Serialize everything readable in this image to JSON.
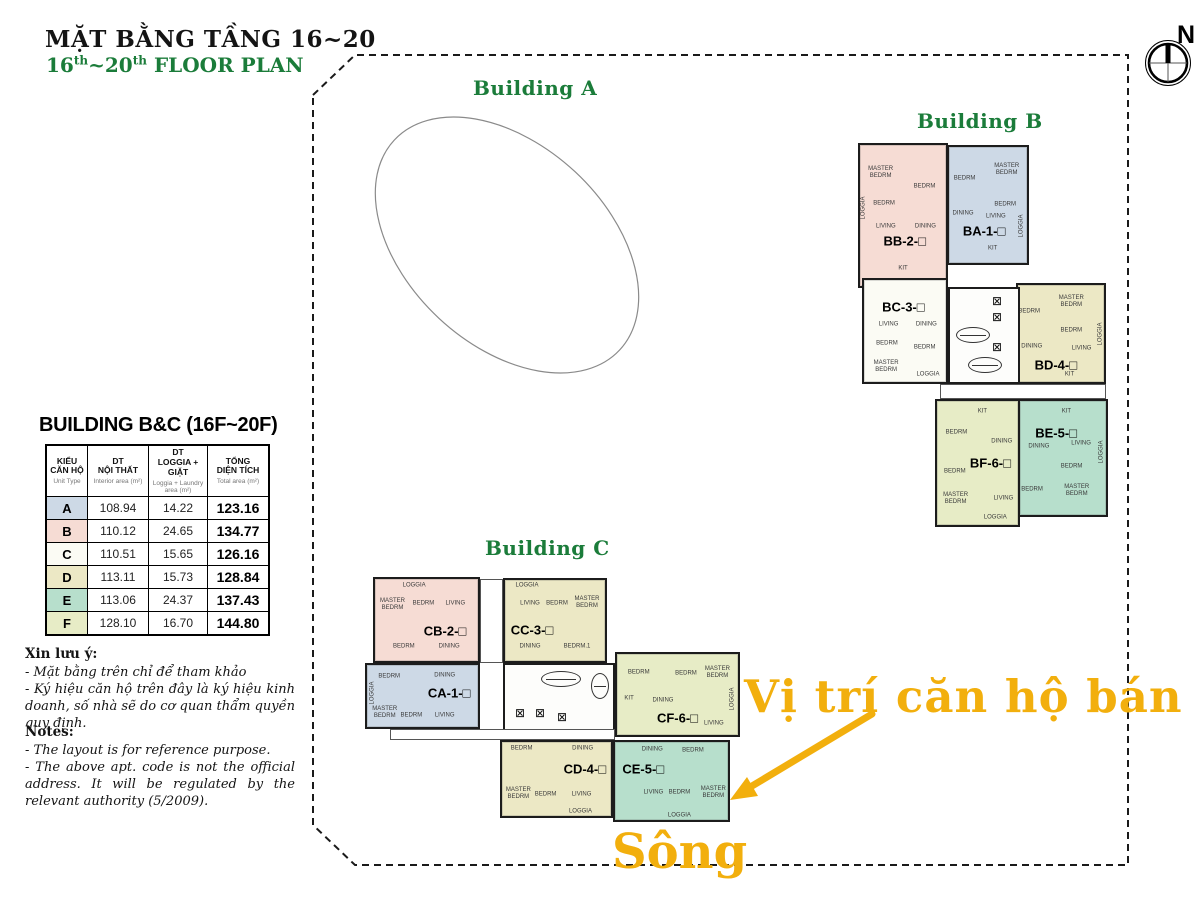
{
  "header": {
    "title_vi": "MẶT BẰNG TẦNG 16~20",
    "title_en": {
      "p1": "16",
      "s1": "th",
      "p2": "~20",
      "s2": "th",
      "p3": " FLOOR PLAN"
    }
  },
  "compass": {
    "label": "N"
  },
  "buildings": {
    "a": "Building A",
    "b": "Building B",
    "c": "Building C"
  },
  "table": {
    "title": "BUILDING B&C (16F~20F)",
    "headers": [
      {
        "vi": "KIỂU\nCĂN HỘ",
        "en": "Unit Type"
      },
      {
        "vi": "DT\nNỘI THẤT",
        "en": "Interior area (m²)"
      },
      {
        "vi": "DT\nLOGGIA + GIẶT",
        "en": "Loggia + Laundry\narea (m²)"
      },
      {
        "vi": "TỔNG\nDIỆN TÍCH",
        "en": "Total area (m²)"
      }
    ],
    "rows": [
      {
        "type": "A",
        "interior": "108.94",
        "loggia": "14.22",
        "total": "123.16",
        "color": "blue"
      },
      {
        "type": "B",
        "interior": "110.12",
        "loggia": "24.65",
        "total": "134.77",
        "color": "pink"
      },
      {
        "type": "C",
        "interior": "110.51",
        "loggia": "15.65",
        "total": "126.16",
        "color": "white"
      },
      {
        "type": "D",
        "interior": "113.11",
        "loggia": "15.73",
        "total": "128.84",
        "color": "cream"
      },
      {
        "type": "E",
        "interior": "113.06",
        "loggia": "24.37",
        "total": "137.43",
        "color": "teal"
      },
      {
        "type": "F",
        "interior": "128.10",
        "loggia": "16.70",
        "total": "144.80",
        "color": "green"
      }
    ]
  },
  "notes_vi": {
    "title": "Xin lưu ý:",
    "lines": [
      "- Mặt bằng trên chỉ để tham khảo",
      "- Ký hiệu căn hộ trên đây là ký hiệu kinh doanh, số nhà sẽ do cơ quan thẩm quyền quy định."
    ]
  },
  "notes_en": {
    "title": "Notes:",
    "lines": [
      "- The layout is for reference purpose.",
      "- The above apt. code is not the official address. It will be regulated by the relevant authority (5/2009)."
    ]
  },
  "annotations": {
    "sale_location": "Vị trí căn hộ bán",
    "river": "Sông",
    "accent_color": "#F2AF0D"
  },
  "icons": {
    "elevator": "⊠"
  },
  "plan": {
    "colors": {
      "pink": "#f6dcd4",
      "blue": "#cdd9e6",
      "cream": "#ece8c5",
      "teal": "#b7dfcc",
      "green": "#e7ecc6",
      "white": "#fbfbf4"
    },
    "units": [
      {
        "code": "BB-2-□",
        "color": "pink",
        "x": 858,
        "y": 143,
        "w": 90,
        "h": 145,
        "lx": 0.52,
        "ly": 0.68,
        "rooms": [
          {
            "n": "MASTER\nBEDRM",
            "x": 0.24,
            "y": 0.2
          },
          {
            "n": "BEDRM",
            "x": 0.75,
            "y": 0.3
          },
          {
            "n": "BEDRM",
            "x": 0.28,
            "y": 0.42
          },
          {
            "n": "LIVING",
            "x": 0.3,
            "y": 0.58
          },
          {
            "n": "DINING",
            "x": 0.76,
            "y": 0.58
          },
          {
            "n": "KIT",
            "x": 0.5,
            "y": 0.88
          },
          {
            "n": "LOGGIA",
            "x": 0.05,
            "y": 0.45,
            "rot": 1
          }
        ]
      },
      {
        "code": "BA-1-□",
        "color": "blue",
        "x": 947,
        "y": 145,
        "w": 82,
        "h": 120,
        "lx": 0.45,
        "ly": 0.72,
        "rooms": [
          {
            "n": "BEDRM",
            "x": 0.2,
            "y": 0.28
          },
          {
            "n": "MASTER\nBEDRM",
            "x": 0.74,
            "y": 0.2
          },
          {
            "n": "BEDRM",
            "x": 0.72,
            "y": 0.5
          },
          {
            "n": "DINING",
            "x": 0.18,
            "y": 0.58
          },
          {
            "n": "LIVING",
            "x": 0.6,
            "y": 0.6
          },
          {
            "n": "KIT",
            "x": 0.56,
            "y": 0.88
          },
          {
            "n": "LOGGIA",
            "x": 0.94,
            "y": 0.68,
            "rot": 1
          }
        ]
      },
      {
        "code": "BC-3-□",
        "color": "white",
        "x": 862,
        "y": 278,
        "w": 86,
        "h": 106,
        "lx": 0.48,
        "ly": 0.26,
        "rooms": [
          {
            "n": "LIVING",
            "x": 0.3,
            "y": 0.44
          },
          {
            "n": "DINING",
            "x": 0.76,
            "y": 0.44
          },
          {
            "n": "BEDRM",
            "x": 0.28,
            "y": 0.63
          },
          {
            "n": "BEDRM",
            "x": 0.74,
            "y": 0.67
          },
          {
            "n": "MASTER\nBEDRM",
            "x": 0.27,
            "y": 0.85
          },
          {
            "n": "LOGGIA",
            "x": 0.78,
            "y": 0.93
          }
        ]
      },
      {
        "code": "BD-4-□",
        "color": "cream",
        "x": 1016,
        "y": 283,
        "w": 90,
        "h": 101,
        "lx": 0.44,
        "ly": 0.82,
        "rooms": [
          {
            "n": "BEDRM",
            "x": 0.13,
            "y": 0.28
          },
          {
            "n": "MASTER\nBEDRM",
            "x": 0.62,
            "y": 0.18
          },
          {
            "n": "BEDRM",
            "x": 0.62,
            "y": 0.47
          },
          {
            "n": "DINING",
            "x": 0.16,
            "y": 0.64
          },
          {
            "n": "LIVING",
            "x": 0.74,
            "y": 0.66
          },
          {
            "n": "KIT",
            "x": 0.6,
            "y": 0.93
          },
          {
            "n": "LOGGIA",
            "x": 0.96,
            "y": 0.5,
            "rot": 1
          }
        ]
      },
      {
        "code": "BE-5-□",
        "color": "teal",
        "x": 1018,
        "y": 399,
        "w": 90,
        "h": 118,
        "lx": 0.42,
        "ly": 0.28,
        "rooms": [
          {
            "n": "KIT",
            "x": 0.54,
            "y": 0.1
          },
          {
            "n": "DINING",
            "x": 0.22,
            "y": 0.4
          },
          {
            "n": "LIVING",
            "x": 0.71,
            "y": 0.38
          },
          {
            "n": "BEDRM",
            "x": 0.6,
            "y": 0.58
          },
          {
            "n": "BEDRM",
            "x": 0.14,
            "y": 0.78
          },
          {
            "n": "MASTER\nBEDRM",
            "x": 0.66,
            "y": 0.79
          },
          {
            "n": "LOGGIA",
            "x": 0.95,
            "y": 0.45,
            "rot": 1
          }
        ]
      },
      {
        "code": "BF-6-□",
        "color": "green",
        "x": 935,
        "y": 399,
        "w": 85,
        "h": 128,
        "lx": 0.66,
        "ly": 0.5,
        "rooms": [
          {
            "n": "KIT",
            "x": 0.56,
            "y": 0.09
          },
          {
            "n": "BEDRM",
            "x": 0.24,
            "y": 0.26
          },
          {
            "n": "DINING",
            "x": 0.8,
            "y": 0.33
          },
          {
            "n": "BEDRM",
            "x": 0.22,
            "y": 0.57
          },
          {
            "n": "MASTER\nBEDRM",
            "x": 0.23,
            "y": 0.79
          },
          {
            "n": "LIVING",
            "x": 0.82,
            "y": 0.79
          },
          {
            "n": "LOGGIA",
            "x": 0.72,
            "y": 0.94
          }
        ]
      },
      {
        "code": "CB-2-□",
        "color": "pink",
        "x": 373,
        "y": 577,
        "w": 107,
        "h": 86,
        "lx": 0.68,
        "ly": 0.64,
        "rooms": [
          {
            "n": "LOGGIA",
            "x": 0.38,
            "y": 0.08
          },
          {
            "n": "MASTER\nBEDRM",
            "x": 0.17,
            "y": 0.32
          },
          {
            "n": "BEDRM",
            "x": 0.47,
            "y": 0.3
          },
          {
            "n": "LIVING",
            "x": 0.78,
            "y": 0.3
          },
          {
            "n": "BEDRM",
            "x": 0.28,
            "y": 0.83
          },
          {
            "n": "DINING",
            "x": 0.72,
            "y": 0.83
          }
        ]
      },
      {
        "code": "CC-3-□",
        "color": "cream",
        "x": 503,
        "y": 578,
        "w": 104,
        "h": 85,
        "lx": 0.27,
        "ly": 0.62,
        "rooms": [
          {
            "n": "LOGGIA",
            "x": 0.22,
            "y": 0.07
          },
          {
            "n": "LIVING",
            "x": 0.25,
            "y": 0.3
          },
          {
            "n": "BEDRM",
            "x": 0.52,
            "y": 0.3
          },
          {
            "n": "MASTER\nBEDRM",
            "x": 0.82,
            "y": 0.28
          },
          {
            "n": "DINING",
            "x": 0.25,
            "y": 0.83
          },
          {
            "n": "BEDRM.1",
            "x": 0.72,
            "y": 0.83
          }
        ]
      },
      {
        "code": "CA-1-□",
        "color": "blue",
        "x": 365,
        "y": 663,
        "w": 115,
        "h": 66,
        "lx": 0.74,
        "ly": 0.45,
        "rooms": [
          {
            "n": "BEDRM",
            "x": 0.2,
            "y": 0.2
          },
          {
            "n": "DINING",
            "x": 0.7,
            "y": 0.17
          },
          {
            "n": "MASTER\nBEDRM",
            "x": 0.16,
            "y": 0.78
          },
          {
            "n": "BEDRM",
            "x": 0.4,
            "y": 0.82
          },
          {
            "n": "LIVING",
            "x": 0.7,
            "y": 0.82
          },
          {
            "n": "LOGGIA",
            "x": 0.05,
            "y": 0.45,
            "rot": 1
          }
        ]
      },
      {
        "code": "CF-6-□",
        "color": "green",
        "x": 615,
        "y": 652,
        "w": 125,
        "h": 85,
        "lx": 0.5,
        "ly": 0.79,
        "rooms": [
          {
            "n": "BEDRM",
            "x": 0.18,
            "y": 0.24
          },
          {
            "n": "BEDRM",
            "x": 0.57,
            "y": 0.25
          },
          {
            "n": "MASTER\nBEDRM",
            "x": 0.83,
            "y": 0.24
          },
          {
            "n": "KIT",
            "x": 0.1,
            "y": 0.56
          },
          {
            "n": "DINING",
            "x": 0.38,
            "y": 0.58
          },
          {
            "n": "LIVING",
            "x": 0.8,
            "y": 0.87
          },
          {
            "n": "LOGGIA",
            "x": 0.96,
            "y": 0.55,
            "rot": 1
          }
        ]
      },
      {
        "code": "CD-4-□",
        "color": "cream",
        "x": 500,
        "y": 740,
        "w": 113,
        "h": 78,
        "lx": 0.76,
        "ly": 0.37,
        "rooms": [
          {
            "n": "BEDRM",
            "x": 0.18,
            "y": 0.1
          },
          {
            "n": "DINING",
            "x": 0.74,
            "y": 0.1
          },
          {
            "n": "MASTER\nBEDRM",
            "x": 0.15,
            "y": 0.7
          },
          {
            "n": "BEDRM",
            "x": 0.4,
            "y": 0.71
          },
          {
            "n": "LIVING",
            "x": 0.73,
            "y": 0.71
          },
          {
            "n": "LOGGIA",
            "x": 0.72,
            "y": 0.94
          }
        ]
      },
      {
        "code": "CE-5-□",
        "color": "teal",
        "x": 613,
        "y": 740,
        "w": 117,
        "h": 82,
        "lx": 0.25,
        "ly": 0.34,
        "rooms": [
          {
            "n": "DINING",
            "x": 0.33,
            "y": 0.1
          },
          {
            "n": "BEDRM",
            "x": 0.69,
            "y": 0.12
          },
          {
            "n": "LIVING",
            "x": 0.34,
            "y": 0.66
          },
          {
            "n": "BEDRM",
            "x": 0.57,
            "y": 0.66
          },
          {
            "n": "MASTER\nBEDRM",
            "x": 0.87,
            "y": 0.66
          },
          {
            "n": "LOGGIA",
            "x": 0.57,
            "y": 0.95
          }
        ]
      }
    ],
    "cores": [
      {
        "x": 948,
        "y": 287,
        "w": 72,
        "h": 97,
        "stairs": [
          {
            "x": 6,
            "y": 38,
            "w": 34,
            "h": 16
          },
          {
            "x": 18,
            "y": 68,
            "w": 34,
            "h": 16
          }
        ],
        "elevs": [
          {
            "x": 42,
            "y": 6
          },
          {
            "x": 42,
            "y": 22
          },
          {
            "x": 42,
            "y": 52
          }
        ]
      },
      {
        "x": 503,
        "y": 663,
        "w": 112,
        "h": 74,
        "stairs": [
          {
            "x": 36,
            "y": 6,
            "w": 40,
            "h": 16
          },
          {
            "x": 86,
            "y": 8,
            "w": 18,
            "h": 26
          }
        ],
        "elevs": [
          {
            "x": 10,
            "y": 42
          },
          {
            "x": 30,
            "y": 42
          },
          {
            "x": 52,
            "y": 46
          }
        ]
      }
    ],
    "corridors": [
      {
        "x": 940,
        "y": 384,
        "w": 166,
        "h": 15
      },
      {
        "x": 390,
        "y": 729,
        "w": 225,
        "h": 11
      },
      {
        "x": 480,
        "y": 579,
        "w": 23,
        "h": 84
      }
    ]
  }
}
